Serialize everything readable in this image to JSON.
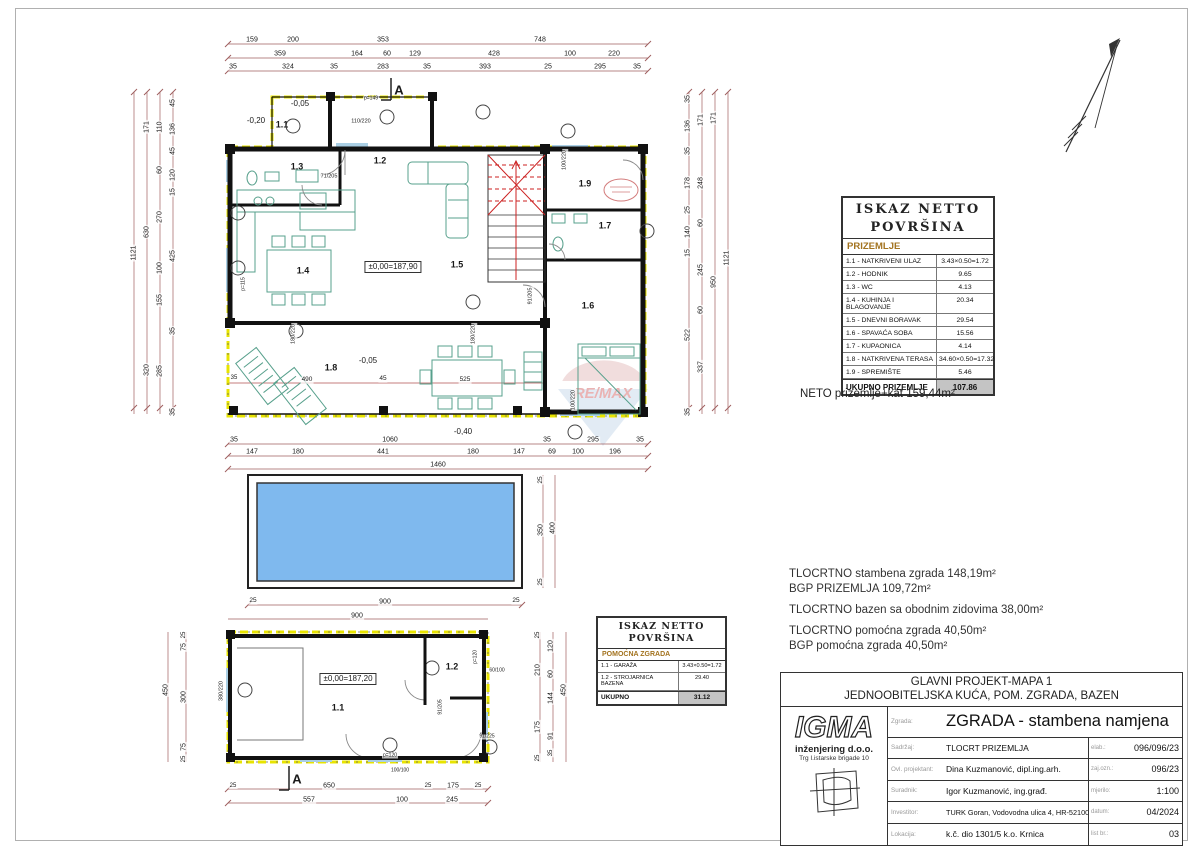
{
  "watermark": {
    "text": "RE/MAX"
  },
  "tables": {
    "prizemlje": {
      "title1": "ISKAZ NETTO",
      "title2": "POVRŠINA",
      "subtitle": "PRIZEMLJE",
      "rows": [
        [
          "1.1 - NATKRIVENI ULAZ",
          "3.43×0.50=1.72"
        ],
        [
          "1.2 - HODNIK",
          "9.65"
        ],
        [
          "1.3 - WC",
          "4.13"
        ],
        [
          "1.4 - KUHINJA I BLAGOVANJE",
          "20.34"
        ],
        [
          "1.5 - DNEVNI BORAVAK",
          "29.54"
        ],
        [
          "1.6 - SPAVAĆA SOBA",
          "15.56"
        ],
        [
          "1.7 - KUPAONICA",
          "4.14"
        ],
        [
          "1.8 - NATKRIVENA TERASA",
          "34.60×0.50=17.32"
        ],
        [
          "1.9 - SPREMIŠTE",
          "5.46"
        ]
      ],
      "total_label": "UKUPNO PRIZEMLJE",
      "total_value": "107.86",
      "note": "NETO prizemlje+kat 159,44m²"
    },
    "pomocna": {
      "title1": "ISKAZ NETTO",
      "title2": "POVRŠINA",
      "subtitle": "POMOĆNA ZGRADA",
      "rows": [
        [
          "1.1 - GARAŽA",
          "3.43×0.50=1.72"
        ],
        [
          "1.2 - STROJARNICA BAZENA",
          "29.40"
        ]
      ],
      "total_label": "UKUPNO",
      "total_value": "31.12"
    }
  },
  "notes": {
    "areas": [
      "TLOCRTNO stambena zgrada 148,19m²",
      "BGP PRIZEMLJA 109,72m²",
      "TLOCRTNO bazen sa obodnim zidovima 38,00m²",
      "TLOCRTNO pomoćna zgrada 40,50m²",
      "BGP pomoćna zgrada 40,50m²"
    ]
  },
  "title_block": {
    "project_line1": "GLAVNI PROJEKT-MAPA 1",
    "project_line2": "JEDNOOBITELJSKA KUĆA, POM. ZGRADA, BAZEN",
    "company": {
      "logo": "IGMA",
      "name": "inženjering d.o.o.",
      "address": "Trg I.istarske brigade 10"
    },
    "rows": [
      {
        "label": "Zgrada:",
        "value": "ZGRADA - stambena namjena",
        "meta_label": "",
        "meta_value": ""
      },
      {
        "label": "Sadržaj:",
        "value": "TLOCRT PRIZEMLJA",
        "meta_label": "elab.:",
        "meta_value": "096/096/23"
      },
      {
        "label": "Ovl. projektant:",
        "value": "Dina Kuzmanović, dipl.ing.arh.",
        "meta_label": "zaj.ozn.:",
        "meta_value": "096/23"
      },
      {
        "label": "Suradnik:",
        "value": "Igor Kuzmanović, ing.građ.",
        "meta_label": "mjerilo:",
        "meta_value": "1:100"
      },
      {
        "label": "Investitor:",
        "value": "TURK Goran, Vodovodna ulica 4, HR-52100 Pula",
        "meta_label": "datum:",
        "meta_value": "04/2024"
      },
      {
        "label": "Lokacija:",
        "value": "k.č. dio 1301/5 k.o. Krnica",
        "meta_label": "list br.:",
        "meta_value": "03"
      }
    ]
  },
  "plan_labels": [
    {
      "t": "159",
      "x": 252,
      "y": 40
    },
    {
      "t": "200",
      "x": 293,
      "y": 40
    },
    {
      "t": "353",
      "x": 383,
      "y": 40
    },
    {
      "t": "748",
      "x": 540,
      "y": 40
    },
    {
      "t": "359",
      "x": 280,
      "y": 54
    },
    {
      "t": "164",
      "x": 357,
      "y": 54
    },
    {
      "t": "60",
      "x": 387,
      "y": 54
    },
    {
      "t": "129",
      "x": 415,
      "y": 54
    },
    {
      "t": "428",
      "x": 494,
      "y": 54
    },
    {
      "t": "100",
      "x": 570,
      "y": 54
    },
    {
      "t": "220",
      "x": 614,
      "y": 54
    },
    {
      "t": "35",
      "x": 233,
      "y": 67
    },
    {
      "t": "324",
      "x": 288,
      "y": 67
    },
    {
      "t": "35",
      "x": 334,
      "y": 67
    },
    {
      "t": "283",
      "x": 383,
      "y": 67
    },
    {
      "t": "35",
      "x": 427,
      "y": 67
    },
    {
      "t": "393",
      "x": 485,
      "y": 67
    },
    {
      "t": "25",
      "x": 548,
      "y": 67
    },
    {
      "t": "295",
      "x": 600,
      "y": 67
    },
    {
      "t": "35",
      "x": 637,
      "y": 67
    },
    {
      "t": "-0,40",
      "x": 463,
      "y": 432,
      "s": 8
    },
    {
      "t": "35",
      "x": 234,
      "y": 440
    },
    {
      "t": "1060",
      "x": 390,
      "y": 440
    },
    {
      "t": "35",
      "x": 547,
      "y": 440
    },
    {
      "t": "295",
      "x": 593,
      "y": 440
    },
    {
      "t": "35",
      "x": 640,
      "y": 440
    },
    {
      "t": "147",
      "x": 252,
      "y": 452
    },
    {
      "t": "180",
      "x": 298,
      "y": 452
    },
    {
      "t": "441",
      "x": 383,
      "y": 452
    },
    {
      "t": "180",
      "x": 473,
      "y": 452
    },
    {
      "t": "147",
      "x": 519,
      "y": 452
    },
    {
      "t": "69",
      "x": 552,
      "y": 452
    },
    {
      "t": "100",
      "x": 578,
      "y": 452
    },
    {
      "t": "196",
      "x": 615,
      "y": 452
    },
    {
      "t": "1460",
      "x": 438,
      "y": 465
    },
    {
      "t": "1121",
      "x": 134,
      "y": 253,
      "r": 1
    },
    {
      "t": "171",
      "x": 147,
      "y": 127,
      "r": 1
    },
    {
      "t": "630",
      "x": 147,
      "y": 232,
      "r": 1
    },
    {
      "t": "320",
      "x": 147,
      "y": 370,
      "r": 1
    },
    {
      "t": "110",
      "x": 160,
      "y": 127,
      "r": 1
    },
    {
      "t": "60",
      "x": 160,
      "y": 170,
      "r": 1
    },
    {
      "t": "270",
      "x": 160,
      "y": 217,
      "r": 1
    },
    {
      "t": "100",
      "x": 160,
      "y": 268,
      "r": 1
    },
    {
      "t": "155",
      "x": 160,
      "y": 300,
      "r": 1
    },
    {
      "t": "285",
      "x": 160,
      "y": 371,
      "r": 1
    },
    {
      "t": "45",
      "x": 173,
      "y": 103,
      "r": 1
    },
    {
      "t": "136",
      "x": 173,
      "y": 129,
      "r": 1
    },
    {
      "t": "45",
      "x": 173,
      "y": 151,
      "r": 1
    },
    {
      "t": "120",
      "x": 173,
      "y": 175,
      "r": 1
    },
    {
      "t": "15",
      "x": 173,
      "y": 192,
      "r": 1
    },
    {
      "t": "425",
      "x": 173,
      "y": 256,
      "r": 1
    },
    {
      "t": "35",
      "x": 173,
      "y": 331,
      "r": 1
    },
    {
      "t": "35",
      "x": 173,
      "y": 412,
      "r": 1
    },
    {
      "t": "35",
      "x": 688,
      "y": 99,
      "r": 1
    },
    {
      "t": "136",
      "x": 688,
      "y": 126,
      "r": 1
    },
    {
      "t": "35",
      "x": 688,
      "y": 151,
      "r": 1
    },
    {
      "t": "178",
      "x": 688,
      "y": 183,
      "r": 1
    },
    {
      "t": "25",
      "x": 688,
      "y": 210,
      "r": 1
    },
    {
      "t": "140",
      "x": 688,
      "y": 232,
      "r": 1
    },
    {
      "t": "15",
      "x": 688,
      "y": 253,
      "r": 1
    },
    {
      "t": "522",
      "x": 688,
      "y": 335,
      "r": 1
    },
    {
      "t": "35",
      "x": 688,
      "y": 412,
      "r": 1
    },
    {
      "t": "171",
      "x": 701,
      "y": 120,
      "r": 1
    },
    {
      "t": "248",
      "x": 701,
      "y": 183,
      "r": 1
    },
    {
      "t": "60",
      "x": 701,
      "y": 223,
      "r": 1
    },
    {
      "t": "245",
      "x": 701,
      "y": 270,
      "r": 1
    },
    {
      "t": "60",
      "x": 701,
      "y": 310,
      "r": 1
    },
    {
      "t": "337",
      "x": 701,
      "y": 367,
      "r": 1
    },
    {
      "t": "171",
      "x": 714,
      "y": 118,
      "r": 1
    },
    {
      "t": "950",
      "x": 714,
      "y": 282,
      "r": 1
    },
    {
      "t": "1121",
      "x": 727,
      "y": 258,
      "r": 1
    },
    {
      "t": "-0,20",
      "x": 256,
      "y": 121,
      "s": 8
    },
    {
      "t": "-0,05",
      "x": 300,
      "y": 104,
      "s": 8
    },
    {
      "t": "1.1",
      "x": 282,
      "y": 125,
      "s": 9,
      "b": 1
    },
    {
      "t": "1.2",
      "x": 380,
      "y": 161,
      "s": 9,
      "b": 1
    },
    {
      "t": "1.3",
      "x": 297,
      "y": 167,
      "s": 9,
      "b": 1
    },
    {
      "t": "1.4",
      "x": 303,
      "y": 271,
      "s": 9,
      "b": 1
    },
    {
      "t": "1.5",
      "x": 457,
      "y": 265,
      "s": 9,
      "b": 1
    },
    {
      "t": "1.6",
      "x": 588,
      "y": 306,
      "s": 9,
      "b": 1
    },
    {
      "t": "1.7",
      "x": 605,
      "y": 226,
      "s": 9,
      "b": 1
    },
    {
      "t": "1.8",
      "x": 331,
      "y": 368,
      "s": 9,
      "b": 1
    },
    {
      "t": "1.9",
      "x": 585,
      "y": 184,
      "s": 9,
      "b": 1
    },
    {
      "t": "±0,00=187,90",
      "x": 393,
      "y": 267,
      "s": 8,
      "box": 1
    },
    {
      "t": "110/220",
      "x": 361,
      "y": 122,
      "s": 5.5
    },
    {
      "t": "p=149",
      "x": 371,
      "y": 99,
      "s": 5
    },
    {
      "t": "71/205",
      "x": 329,
      "y": 177,
      "s": 5.5
    },
    {
      "t": "100/220",
      "x": 565,
      "y": 160,
      "s": 5.5,
      "r": 1
    },
    {
      "t": "91/205",
      "x": 531,
      "y": 296,
      "s": 5.5,
      "r": 1
    },
    {
      "t": "p=115",
      "x": 244,
      "y": 284,
      "s": 5,
      "r": 1
    },
    {
      "t": "180/220",
      "x": 294,
      "y": 334,
      "s": 5.5,
      "r": 1
    },
    {
      "t": "180/220",
      "x": 474,
      "y": 334,
      "s": 5.5,
      "r": 1
    },
    {
      "t": "100/220",
      "x": 574,
      "y": 400,
      "s": 5.5,
      "r": 1
    },
    {
      "t": "-0,05",
      "x": 368,
      "y": 361,
      "s": 8
    },
    {
      "t": "35",
      "x": 234,
      "y": 378,
      "s": 6
    },
    {
      "t": "490",
      "x": 307,
      "y": 380,
      "s": 6.5
    },
    {
      "t": "45",
      "x": 383,
      "y": 379,
      "s": 6.5
    },
    {
      "t": "525",
      "x": 465,
      "y": 380,
      "s": 6.5
    },
    {
      "t": "A",
      "x": 399,
      "y": 90,
      "s": 13,
      "b": 1
    },
    {
      "t": "A",
      "x": 297,
      "y": 779,
      "s": 13,
      "b": 1
    },
    {
      "t": "25",
      "x": 253,
      "y": 601,
      "s": 6.5
    },
    {
      "t": "900",
      "x": 385,
      "y": 602
    },
    {
      "t": "25",
      "x": 516,
      "y": 601,
      "s": 6.5
    },
    {
      "t": "900",
      "x": 357,
      "y": 616
    },
    {
      "t": "25",
      "x": 541,
      "y": 480,
      "r": 1,
      "s": 6.5
    },
    {
      "t": "350",
      "x": 541,
      "y": 530,
      "r": 1
    },
    {
      "t": "25",
      "x": 541,
      "y": 582,
      "r": 1,
      "s": 6.5
    },
    {
      "t": "400",
      "x": 553,
      "y": 528,
      "r": 1
    },
    {
      "t": "25",
      "x": 184,
      "y": 635,
      "r": 1,
      "s": 6
    },
    {
      "t": "75",
      "x": 184,
      "y": 647,
      "r": 1
    },
    {
      "t": "300",
      "x": 184,
      "y": 697,
      "r": 1
    },
    {
      "t": "75",
      "x": 184,
      "y": 747,
      "r": 1
    },
    {
      "t": "25",
      "x": 184,
      "y": 759,
      "r": 1,
      "s": 6
    },
    {
      "t": "450",
      "x": 166,
      "y": 690,
      "r": 1
    },
    {
      "t": "380/220",
      "x": 222,
      "y": 691,
      "s": 5.5,
      "r": 1
    },
    {
      "t": "±0,00=187,20",
      "x": 348,
      "y": 679,
      "s": 8,
      "box": 1
    },
    {
      "t": "1.1",
      "x": 338,
      "y": 708,
      "s": 9,
      "b": 1
    },
    {
      "t": "1.2",
      "x": 452,
      "y": 667,
      "s": 9,
      "b": 1
    },
    {
      "t": "25",
      "x": 538,
      "y": 635,
      "r": 1,
      "s": 6
    },
    {
      "t": "120",
      "x": 551,
      "y": 646,
      "r": 1
    },
    {
      "t": "210",
      "x": 538,
      "y": 670,
      "r": 1
    },
    {
      "t": "60",
      "x": 551,
      "y": 674,
      "r": 1
    },
    {
      "t": "144",
      "x": 551,
      "y": 698,
      "r": 1
    },
    {
      "t": "175",
      "x": 538,
      "y": 727,
      "r": 1
    },
    {
      "t": "91",
      "x": 551,
      "y": 736,
      "r": 1
    },
    {
      "t": "35",
      "x": 551,
      "y": 753,
      "r": 1,
      "s": 6
    },
    {
      "t": "25",
      "x": 538,
      "y": 758,
      "r": 1,
      "s": 6
    },
    {
      "t": "450",
      "x": 564,
      "y": 690,
      "r": 1
    },
    {
      "t": "25",
      "x": 233,
      "y": 786,
      "s": 6
    },
    {
      "t": "650",
      "x": 329,
      "y": 786
    },
    {
      "t": "25",
      "x": 428,
      "y": 786,
      "s": 6
    },
    {
      "t": "175",
      "x": 453,
      "y": 786
    },
    {
      "t": "25",
      "x": 478,
      "y": 786,
      "s": 6
    },
    {
      "t": "557",
      "x": 309,
      "y": 800
    },
    {
      "t": "100",
      "x": 402,
      "y": 800
    },
    {
      "t": "245",
      "x": 452,
      "y": 800
    },
    {
      "t": "p=120",
      "x": 390,
      "y": 756,
      "s": 5
    },
    {
      "t": "100/100",
      "x": 400,
      "y": 771,
      "s": 5
    },
    {
      "t": "60/100",
      "x": 497,
      "y": 671,
      "s": 5
    },
    {
      "t": "91/205",
      "x": 441,
      "y": 707,
      "s": 5,
      "r": 1
    },
    {
      "t": "91/225",
      "x": 487,
      "y": 737,
      "s": 5
    },
    {
      "t": "p=120",
      "x": 476,
      "y": 657,
      "s": 5,
      "r": 1
    }
  ]
}
